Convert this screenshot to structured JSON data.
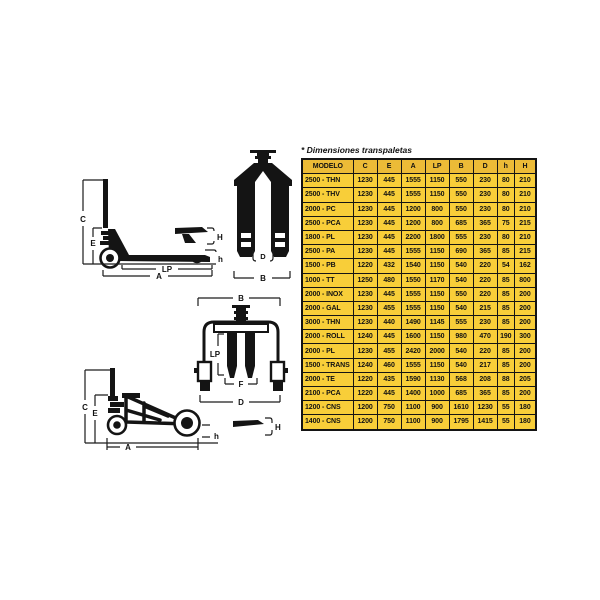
{
  "table": {
    "title": "* Dimensiones transpaletas",
    "columns": [
      "MODELO",
      "C",
      "E",
      "A",
      "LP",
      "B",
      "D",
      "h",
      "H"
    ],
    "rows": [
      [
        "2500 - THN",
        "1230",
        "445",
        "1555",
        "1150",
        "550",
        "230",
        "80",
        "210"
      ],
      [
        "2500 - THV",
        "1230",
        "445",
        "1555",
        "1150",
        "550",
        "230",
        "80",
        "210"
      ],
      [
        "2000 - PC",
        "1230",
        "445",
        "1200",
        "800",
        "550",
        "230",
        "80",
        "210"
      ],
      [
        "2500 - PCA",
        "1230",
        "445",
        "1200",
        "800",
        "685",
        "365",
        "75",
        "215"
      ],
      [
        "1800 - PL",
        "1230",
        "445",
        "2200",
        "1800",
        "555",
        "230",
        "80",
        "210"
      ],
      [
        "2500 - PA",
        "1230",
        "445",
        "1555",
        "1150",
        "690",
        "365",
        "85",
        "215"
      ],
      [
        "1500 - PB",
        "1220",
        "432",
        "1540",
        "1150",
        "540",
        "220",
        "54",
        "162"
      ],
      [
        "1000 - TT",
        "1250",
        "480",
        "1550",
        "1170",
        "540",
        "220",
        "85",
        "800"
      ],
      [
        "2000 - INOX",
        "1230",
        "445",
        "1555",
        "1150",
        "550",
        "220",
        "85",
        "200"
      ],
      [
        "2000 - GAL",
        "1230",
        "455",
        "1555",
        "1150",
        "540",
        "215",
        "85",
        "200"
      ],
      [
        "3000 - THN",
        "1230",
        "440",
        "1490",
        "1145",
        "555",
        "230",
        "85",
        "200"
      ],
      [
        "2000 - ROLL",
        "1240",
        "445",
        "1600",
        "1150",
        "980",
        "470",
        "190",
        "300"
      ],
      [
        "2000 - PL",
        "1230",
        "455",
        "2420",
        "2000",
        "540",
        "220",
        "85",
        "200"
      ],
      [
        "1500 - TRANS",
        "1240",
        "460",
        "1555",
        "1150",
        "540",
        "217",
        "85",
        "200"
      ],
      [
        "2000 - TE",
        "1220",
        "435",
        "1590",
        "1130",
        "568",
        "208",
        "88",
        "205"
      ],
      [
        "2100 - PCA",
        "1220",
        "445",
        "1400",
        "1000",
        "685",
        "365",
        "85",
        "200"
      ],
      [
        "1200 - CNS",
        "1200",
        "750",
        "1100",
        "900",
        "1610",
        "1230",
        "55",
        "180"
      ],
      [
        "1400 - CNS",
        "1200",
        "750",
        "1100",
        "900",
        "1795",
        "1415",
        "55",
        "180"
      ]
    ]
  },
  "colors": {
    "table_header_bg": "#ECBB37",
    "table_row_bg": "#F8CE39",
    "table_border": "#141414",
    "drawing_ink": "#141414"
  },
  "diagrams": {
    "pallet_truck_side": {
      "labels": {
        "C": "C",
        "E": "E",
        "h": "h",
        "LP": "LP",
        "A": "A",
        "H": "H"
      }
    },
    "forks_front": {
      "labels": {
        "D": "D",
        "B": "B"
      }
    },
    "highlift_front": {
      "labels": {
        "B": "B",
        "LP": "LP",
        "F": "F",
        "D": "D"
      }
    },
    "highlift_side": {
      "labels": {
        "C": "C",
        "E": "E",
        "h": "h",
        "A": "A"
      }
    },
    "raised_fork_detail": {
      "labels": {
        "H": "H"
      }
    }
  }
}
